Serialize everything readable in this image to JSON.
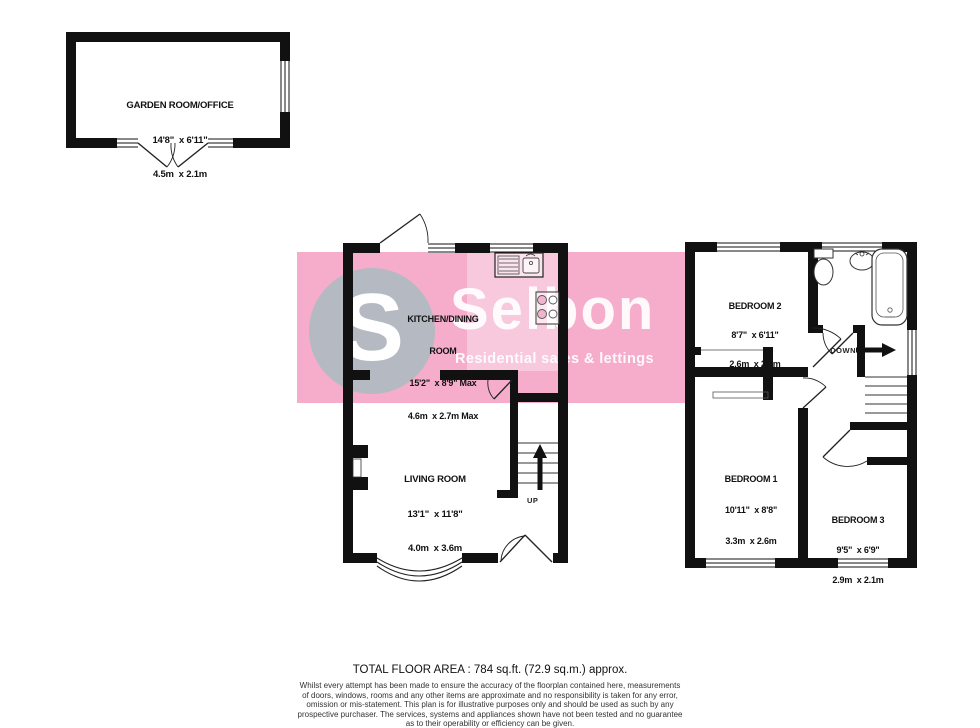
{
  "watermark": {
    "logo_letter": "S",
    "brand": "Selbon",
    "tagline": "Residential sales & lettings",
    "banner_color": "#f5adcb",
    "logo_circle_color": "#b5b9c2"
  },
  "garden_room": {
    "name": "GARDEN ROOM/OFFICE",
    "imperial": "14'8\"  x 6'11\"",
    "metric": "4.5m  x 2.1m"
  },
  "ground_floor": {
    "kitchen": {
      "name_line1": "KITCHEN/DINING",
      "name_line2": "ROOM",
      "imperial": "15'2\"  x 8'9\" Max",
      "metric": "4.6m  x 2.7m Max"
    },
    "living_room": {
      "name": "LIVING ROOM",
      "imperial": "13'1\"  x 11'8\"",
      "metric": "4.0m  x 3.6m"
    },
    "stairs_label": "UP"
  },
  "first_floor": {
    "bedroom2": {
      "name": "BEDROOM 2",
      "imperial": "8'7\"  x 6'11\"",
      "metric": "2.6m  x 2.1m"
    },
    "bedroom1": {
      "name": "BEDROOM 1",
      "imperial": "10'11\"  x 8'8\"",
      "metric": "3.3m  x 2.6m"
    },
    "bedroom3": {
      "name": "BEDROOM 3",
      "imperial": "9'5\"  x 6'9\"",
      "metric": "2.9m  x 2.1m"
    },
    "stairs_label": "DOWN"
  },
  "footer": {
    "total_area": "TOTAL FLOOR AREA : 784 sq.ft. (72.9 sq.m.) approx.",
    "disclaimer_lines": [
      "Whilst every attempt has been made to ensure the accuracy of the floorplan contained here, measurements",
      "of doors, windows, rooms and any other items are approximate and no responsibility is taken for any error,",
      "omission or mis-statement. This plan is for illustrative purposes only and should be used as such by any",
      "prospective purchaser. The services, systems and appliances shown have not been tested and no guarantee",
      "as to their operability or efficiency can be given."
    ],
    "credit": "Made with Metropix ©2026"
  }
}
